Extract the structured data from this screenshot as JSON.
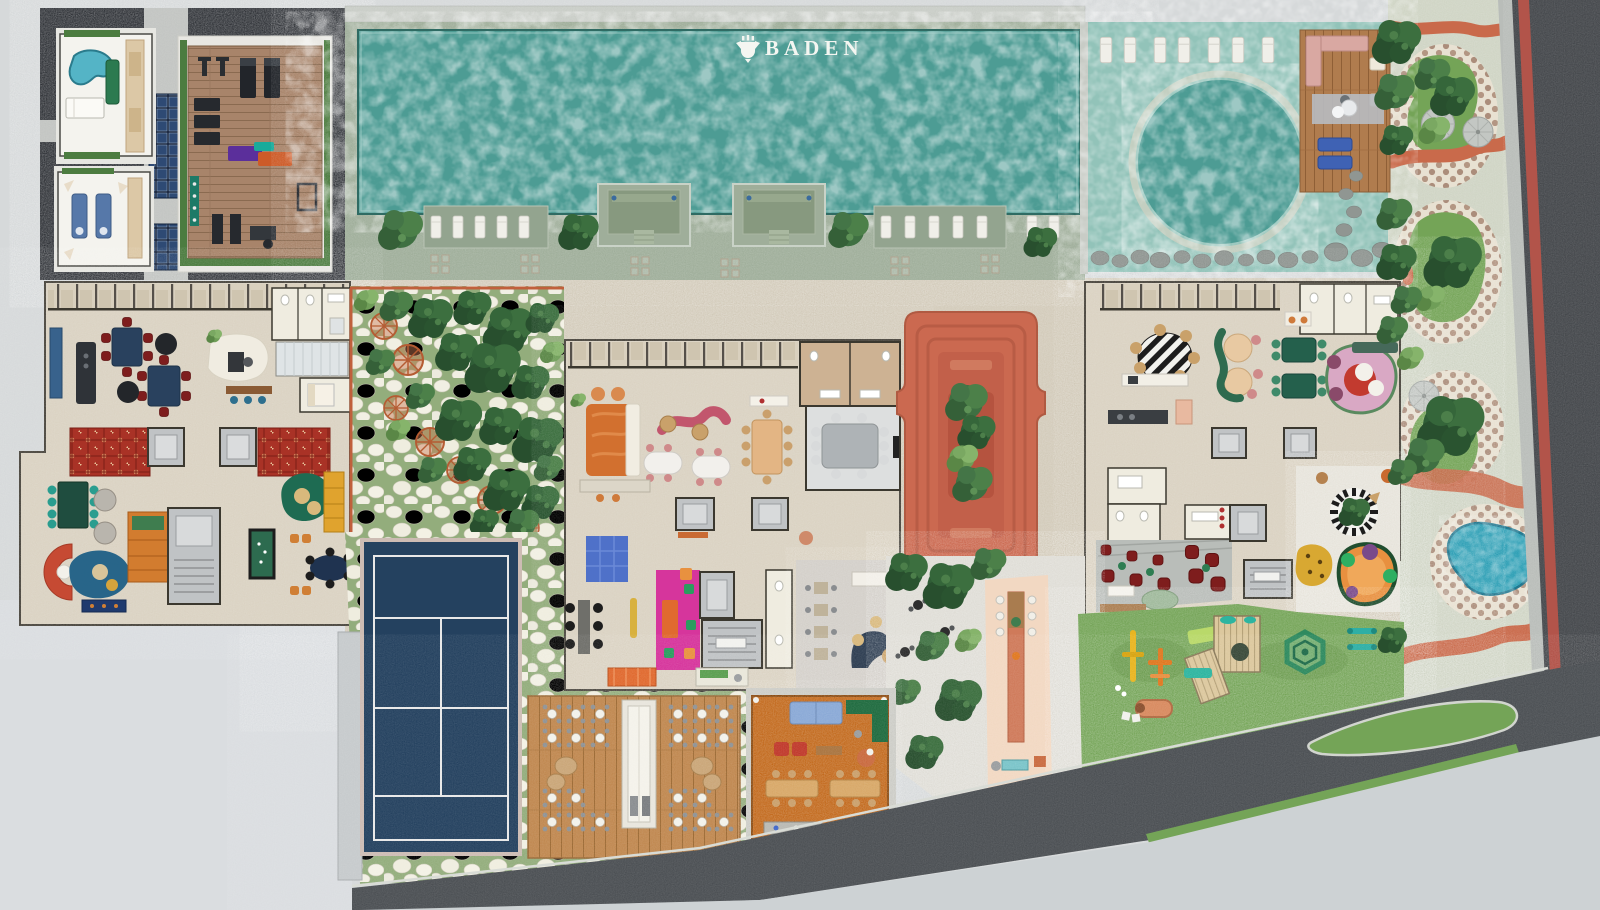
{
  "brand": {
    "logo_text": "BADEN",
    "logo_icon": "baden-crest-icon"
  },
  "palette": {
    "page_bg": "#d6d9da",
    "logo_white": "#f4f6f1",
    "pool_water": "#4d9c94",
    "wetdeck_water": "#92c3b9",
    "pool_deck": "#9fae9a",
    "spa_stone": "#2e3136",
    "floor_beige": "#dad2c2",
    "paving_beige": "#d2cab9",
    "lawn_green": "#74a457",
    "promenade": "#cfd4c4",
    "street_asphalt": "#45484c",
    "road_asphalt": "#4b4f53",
    "street_red_stripe": "#b2544a",
    "terracotta": "#cb6950",
    "court_navy": "#24415f",
    "kidney_pool": "#2d9fb5",
    "party_orange": "#c2691c",
    "core_gray": "#c0c3c5",
    "white_room": "#efece0",
    "curb_gray": "#b9bdb9",
    "sidewalk": "#cdd2d4",
    "magenta_floor": "#d6359c",
    "crazy_paving_green": "#93ad7c",
    "mosaic_dot": "#ab8d7b",
    "gym_wood": "#a8846a",
    "sun_deck_wood": "#b07c4e",
    "bistro_deck_wood": "#c08850",
    "accent_band_orange": "#c96a4b"
  },
  "areas": [
    "wellness-spa-pavilions",
    "fitness-deck",
    "solar-panels",
    "main-lap-pool",
    "pool-lounge-deck",
    "round-plunge-pool",
    "timber-sun-deck",
    "clubhouse-west-wing",
    "games-lounge",
    "forest-garden-hammocks",
    "terracotta-sunken-lounge",
    "clubhouse-center-wing",
    "clubhouse-east-wing",
    "tennis-court",
    "bistro-deck",
    "party-pavilion",
    "outdoor-bar-plaza",
    "playground-lawn",
    "kids-splash-pad",
    "street-promenade",
    "promenade-fountain-pool",
    "access-road",
    "street"
  ]
}
